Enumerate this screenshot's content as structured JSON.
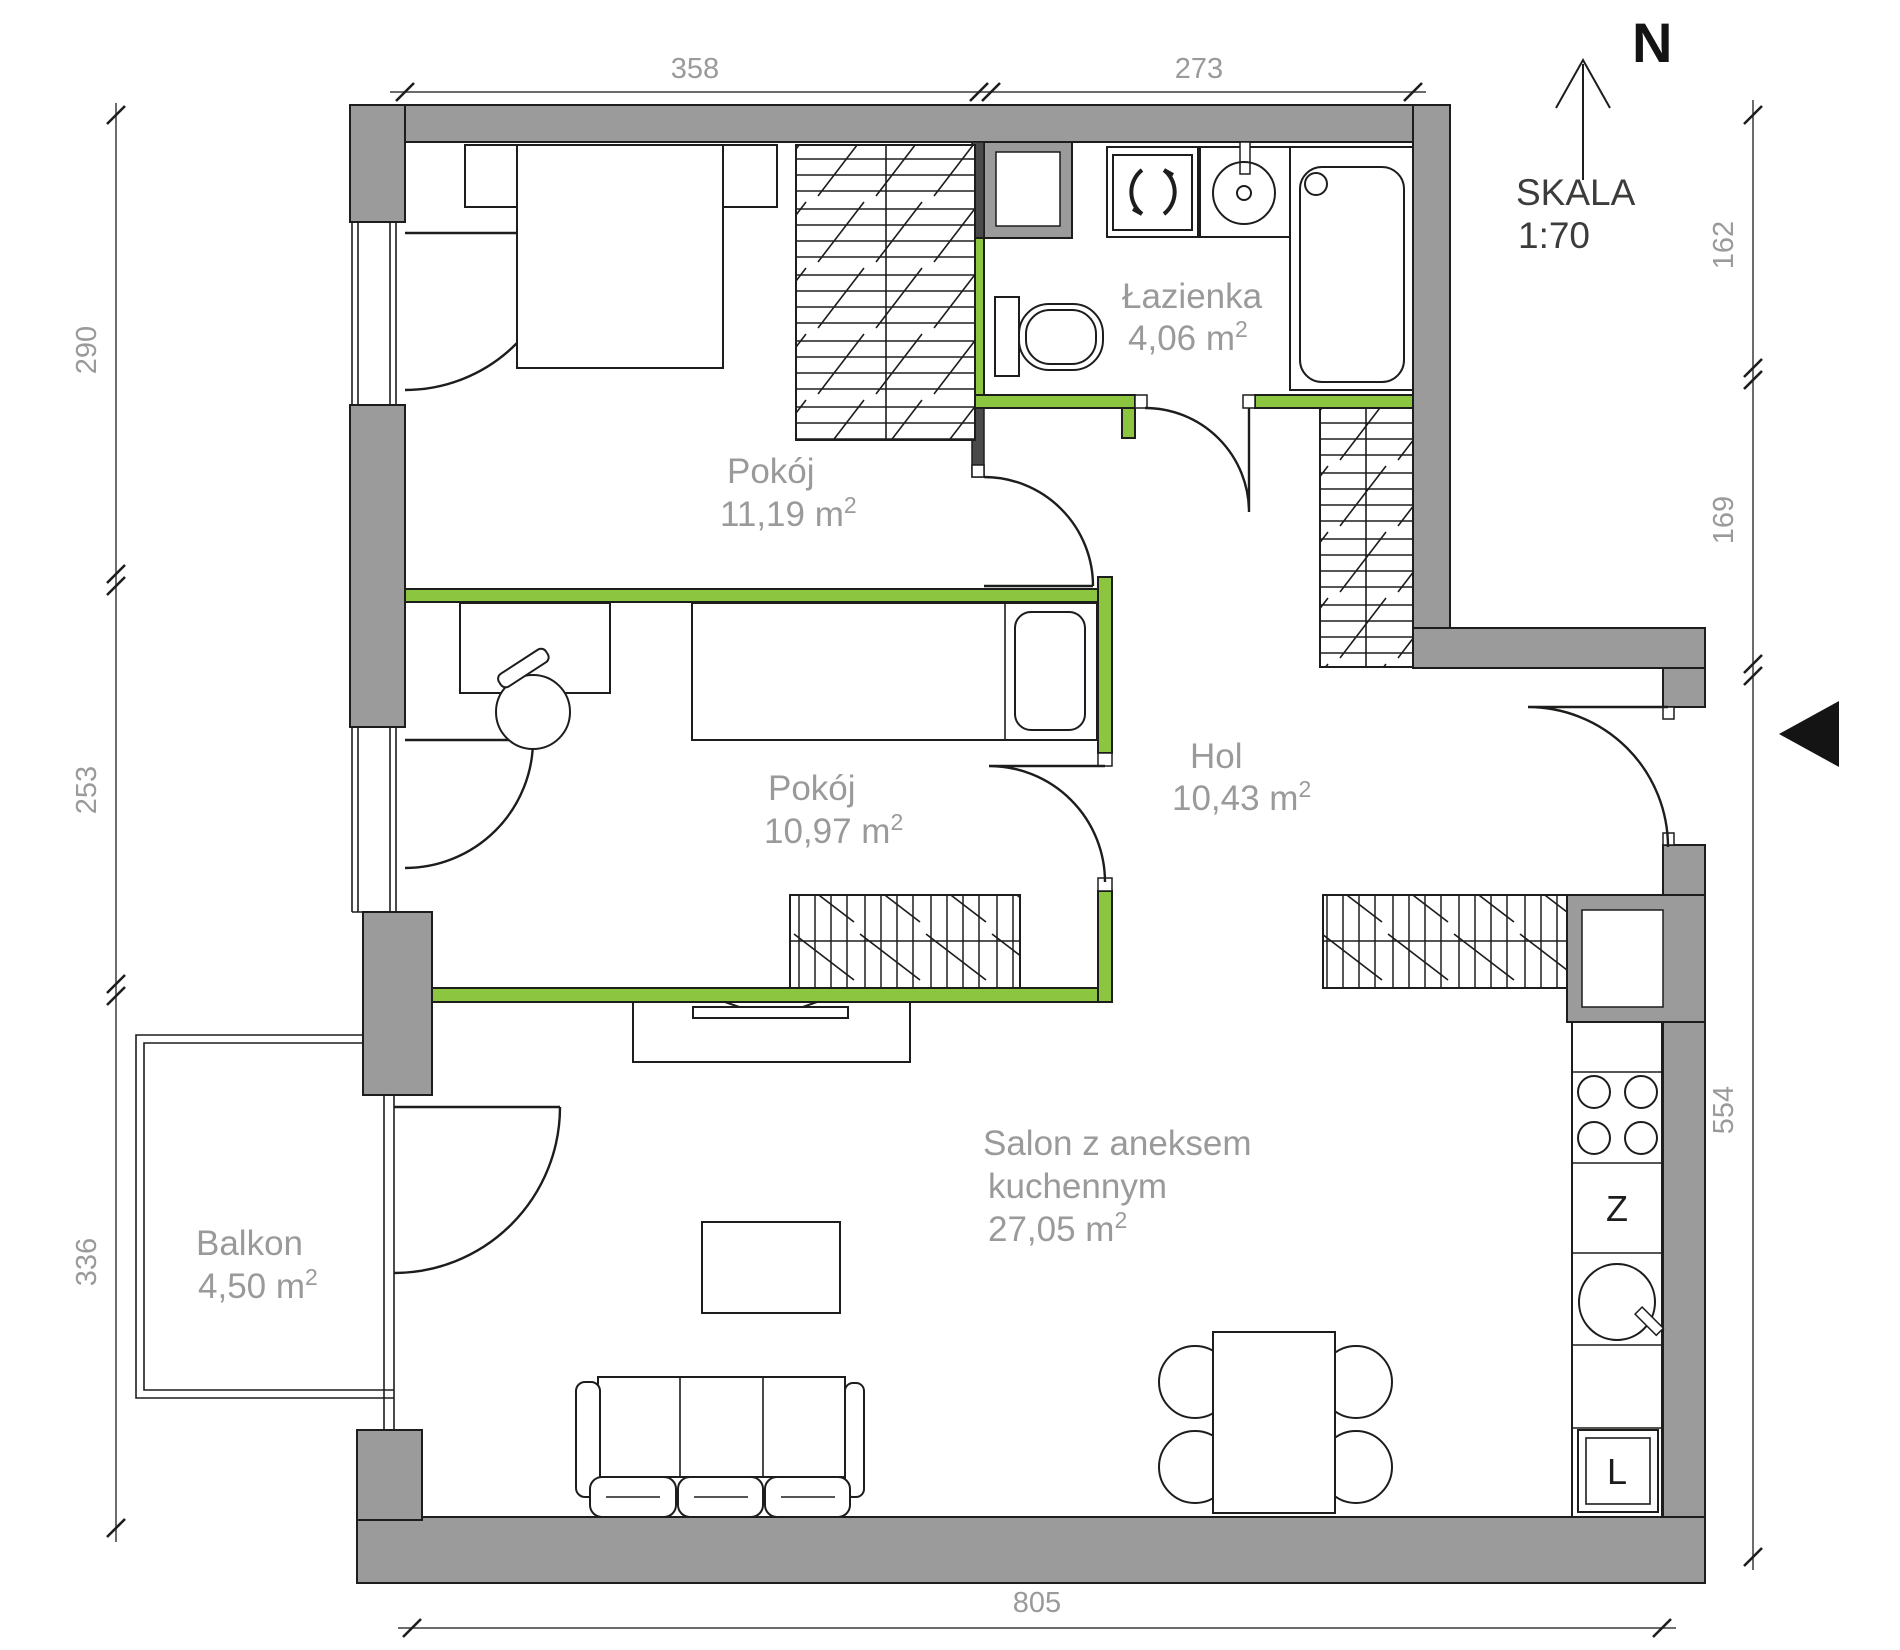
{
  "compass": {
    "north": "N"
  },
  "scale": {
    "label": "SKALA",
    "value": "1:70"
  },
  "rooms": [
    {
      "id": "pokoj-1",
      "name": "Pokój",
      "area": "11,19 m",
      "sup": "2"
    },
    {
      "id": "lazienka",
      "name": "Łazienka",
      "area": "4,06 m",
      "sup": "2"
    },
    {
      "id": "pokoj-2",
      "name": "Pokój",
      "area": "10,97 m",
      "sup": "2"
    },
    {
      "id": "hol",
      "name": "Hol",
      "area": "10,43 m",
      "sup": "2"
    },
    {
      "id": "salon",
      "name_line1": "Salon z aneksem",
      "name_line2": "kuchennym",
      "area": "27,05 m",
      "sup": "2"
    },
    {
      "id": "balkon",
      "name": "Balkon",
      "area": "4,50 m",
      "sup": "2"
    }
  ],
  "dimensions": {
    "top": [
      "358",
      "273"
    ],
    "left": [
      "290",
      "253",
      "336"
    ],
    "right": [
      "162",
      "169",
      "554"
    ],
    "bottom": [
      "805"
    ]
  },
  "kitchen": {
    "dishwasher": "Z",
    "fridge": "L"
  },
  "colors": {
    "wall": "#9b9b9b",
    "accent": "#8cc540",
    "label": "#9a9a9a",
    "line": "#1d1d1b"
  }
}
